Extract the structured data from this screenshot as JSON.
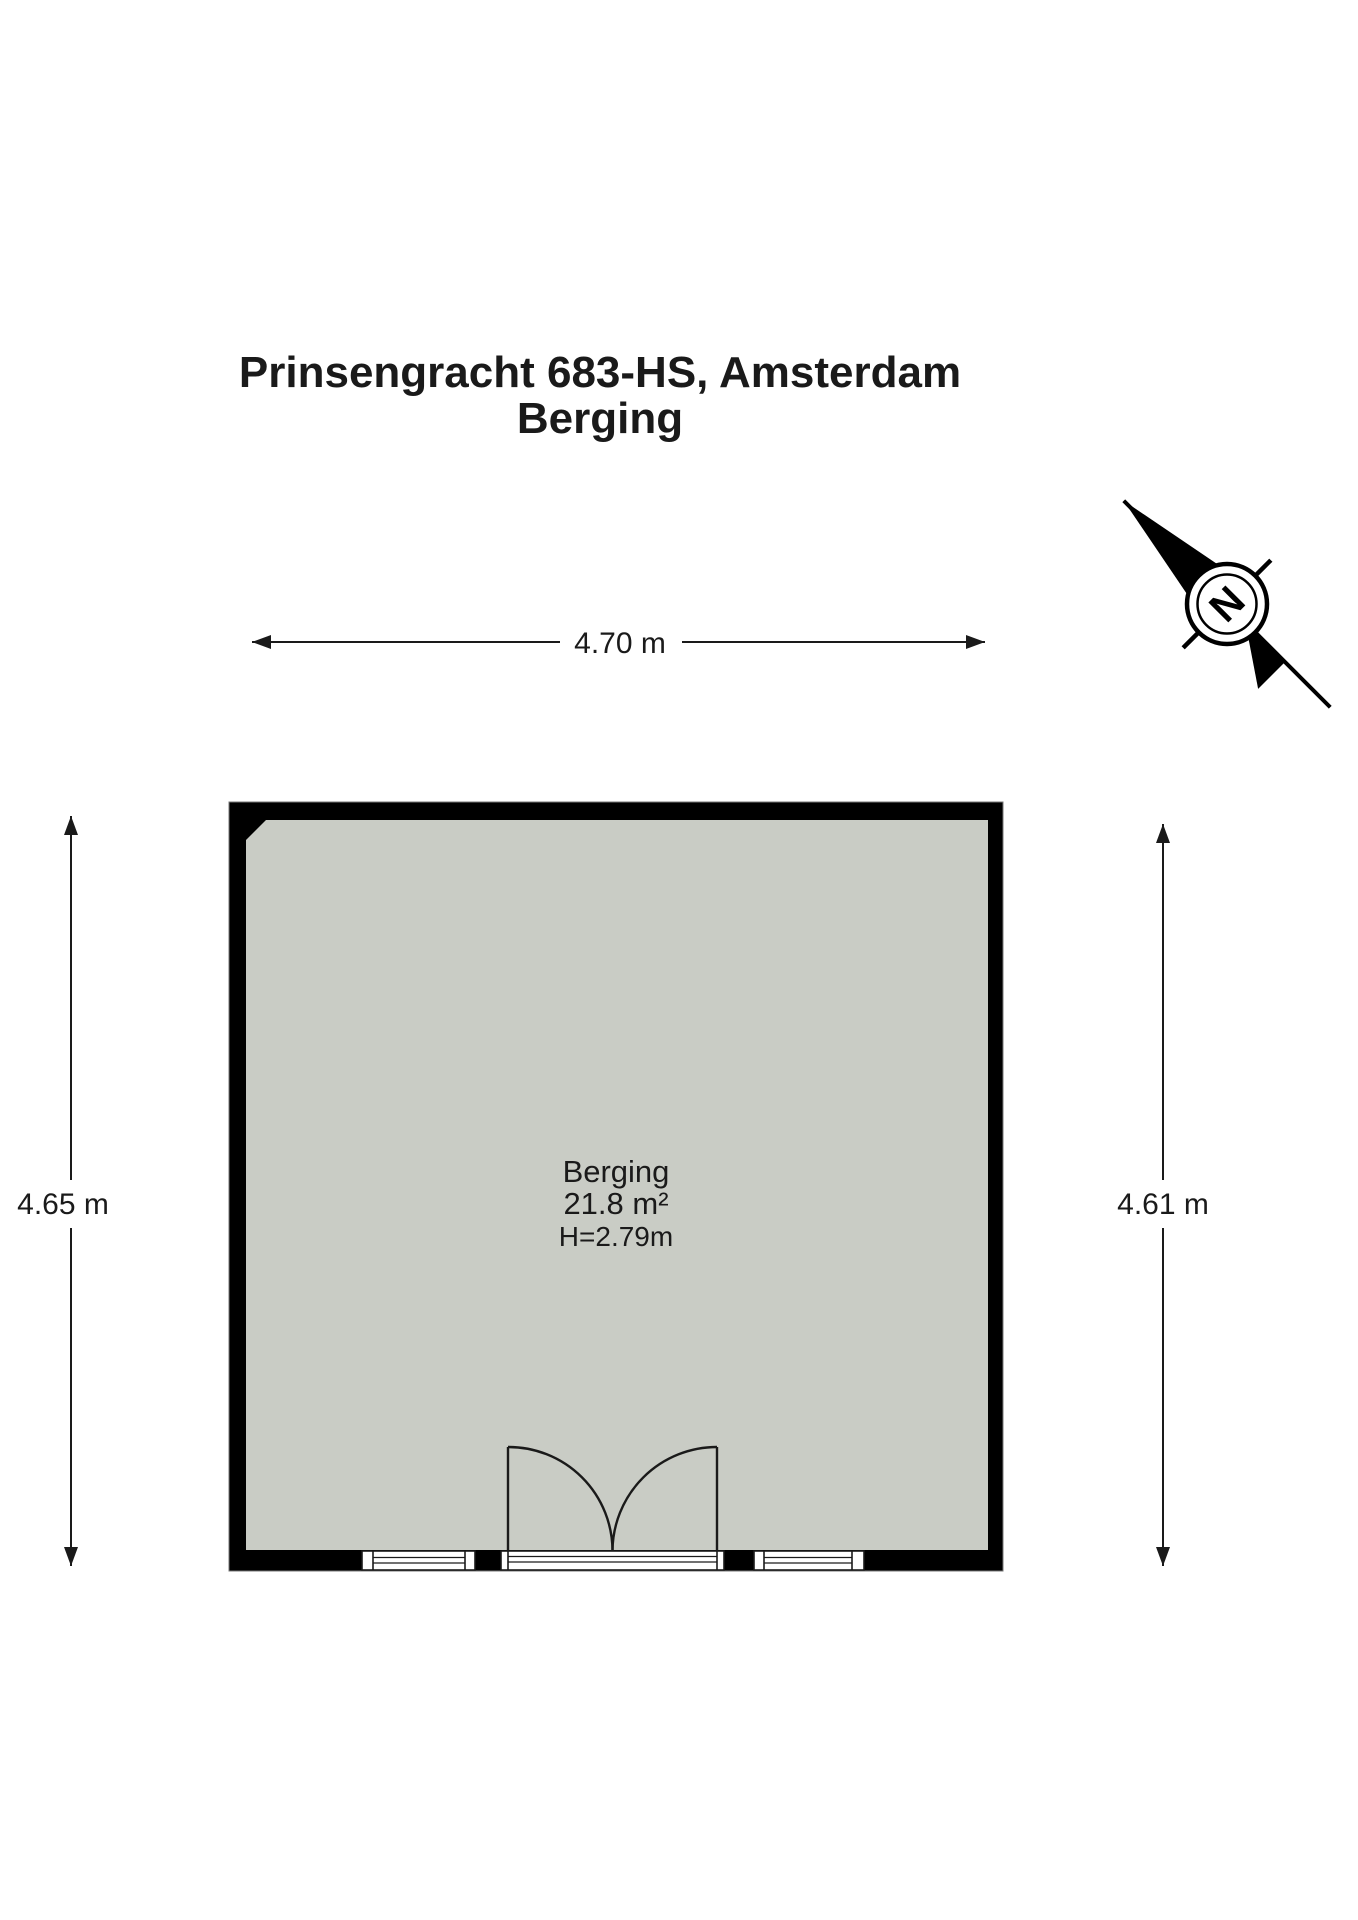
{
  "header": {
    "address": "Prinsengracht 683-HS, Amsterdam",
    "subtitle": "Berging"
  },
  "dimensions": {
    "top": {
      "label": "4.70 m"
    },
    "left": {
      "label": "4.65 m"
    },
    "right": {
      "label": "4.61 m"
    }
  },
  "room": {
    "name": "Berging",
    "area": "21.8 m²",
    "ceiling_height": "H=2.79m"
  },
  "compass": {
    "north_label": "N"
  },
  "colors": {
    "wall": "#000000",
    "floor_fill": "#c9ccc5",
    "line": "#1a1a1a",
    "background": "#ffffff"
  }
}
